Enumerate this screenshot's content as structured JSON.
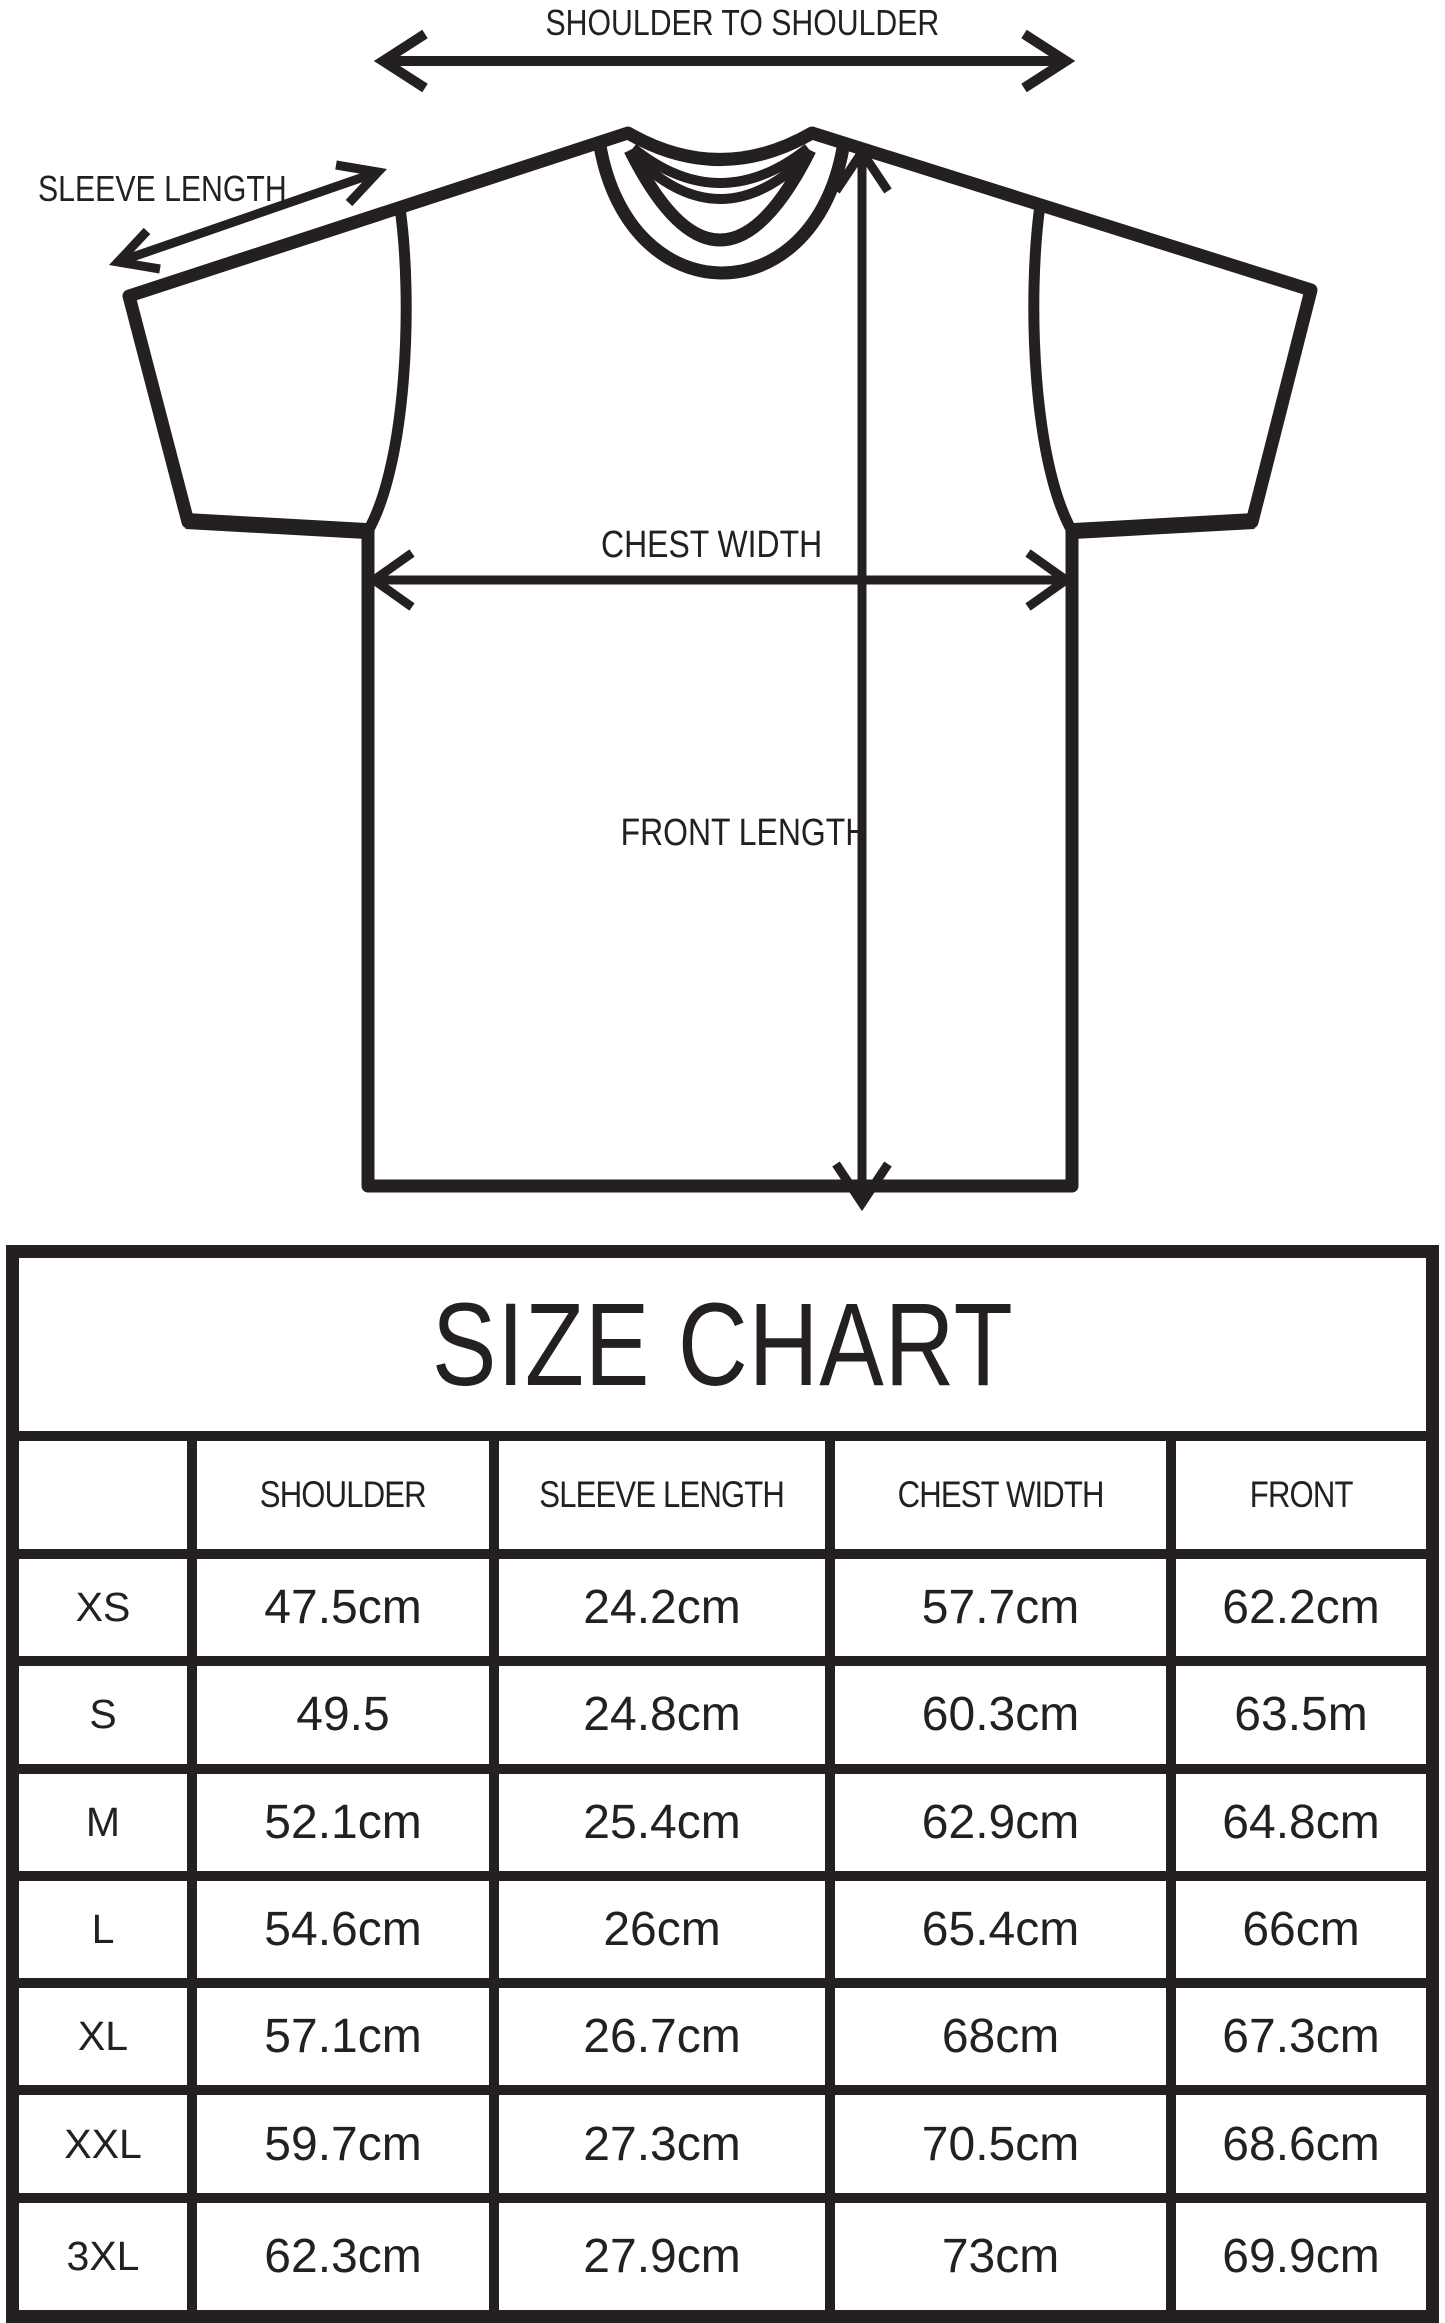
{
  "diagram": {
    "line_color": "#242021",
    "labels": {
      "shoulder_to_shoulder": "SHOULDER TO SHOULDER",
      "sleeve_length": "SLEEVE LENGTH",
      "chest_width": "CHEST WIDTH",
      "front_length": "FRONT LENGTH"
    },
    "icons": [
      "shoulder-to-shoulder-arrow",
      "sleeve-length-arrow",
      "chest-width-arrow",
      "front-length-arrow",
      "tshirt-outline"
    ]
  },
  "size_chart": {
    "title": "SIZE CHART",
    "columns": [
      "",
      "SHOULDER",
      "SLEEVE LENGTH",
      "CHEST WIDTH",
      "FRONT"
    ],
    "rows": [
      {
        "size": "XS",
        "shoulder": "47.5cm",
        "sleeve_length": "24.2cm",
        "chest_width": "57.7cm",
        "front": "62.2cm"
      },
      {
        "size": "S",
        "shoulder": "49.5",
        "sleeve_length": "24.8cm",
        "chest_width": "60.3cm",
        "front": "63.5m"
      },
      {
        "size": "M",
        "shoulder": "52.1cm",
        "sleeve_length": "25.4cm",
        "chest_width": "62.9cm",
        "front": "64.8cm"
      },
      {
        "size": "L",
        "shoulder": "54.6cm",
        "sleeve_length": "26cm",
        "chest_width": "65.4cm",
        "front": "66cm"
      },
      {
        "size": "XL",
        "shoulder": "57.1cm",
        "sleeve_length": "26.7cm",
        "chest_width": "68cm",
        "front": "67.3cm"
      },
      {
        "size": "XXL",
        "shoulder": "59.7cm",
        "sleeve_length": "27.3cm",
        "chest_width": "70.5cm",
        "front": "68.6cm"
      },
      {
        "size": "3XL",
        "shoulder": "62.3cm",
        "sleeve_length": "27.9cm",
        "chest_width": "73cm",
        "front": "69.9cm"
      }
    ]
  }
}
